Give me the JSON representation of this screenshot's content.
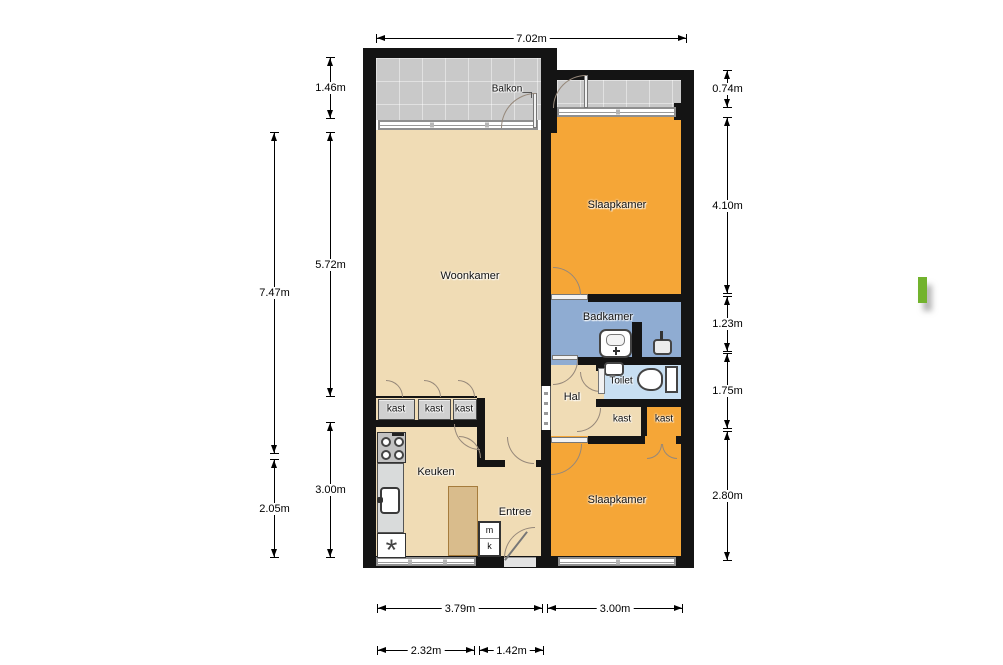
{
  "plan": {
    "rooms": {
      "balkon": "Balkon",
      "woonkamer": "Woonkamer",
      "slaapkamer_top": "Slaapkamer",
      "badkamer": "Badkamer",
      "toilet": "Toilet",
      "hal": "Hal",
      "keuken": "Keuken",
      "entree": "Entree",
      "slaapkamer_bottom": "Slaapkamer",
      "kast_row": [
        "kast",
        "kast",
        "kast"
      ],
      "kast_beige": "kast",
      "kast_orange": "kast",
      "meter_closet": [
        "m",
        "k"
      ]
    },
    "dimensions": {
      "top": "7.02m",
      "left_outer": [
        "7.47m",
        "2.05m"
      ],
      "left_inner": [
        "1.46m",
        "5.72m",
        "3.00m"
      ],
      "right": [
        "0.74m",
        "4.10m",
        "1.23m",
        "1.75m",
        "2.80m"
      ],
      "bottom_row1": [
        "3.79m",
        "3.00m"
      ],
      "bottom_row2": [
        "2.32m",
        "1.42m"
      ]
    },
    "fixtures": {
      "washer_symbol": "*"
    },
    "colors": {
      "wall": "#141414",
      "floor_beige": "#f0dcb5",
      "bedroom_orange": "#f5a637",
      "bathroom_blue": "#8facd2",
      "toilet_blue": "#c8dff2",
      "balcony_gray": "#c9c9c9",
      "marker_green": "#72b32d"
    }
  }
}
